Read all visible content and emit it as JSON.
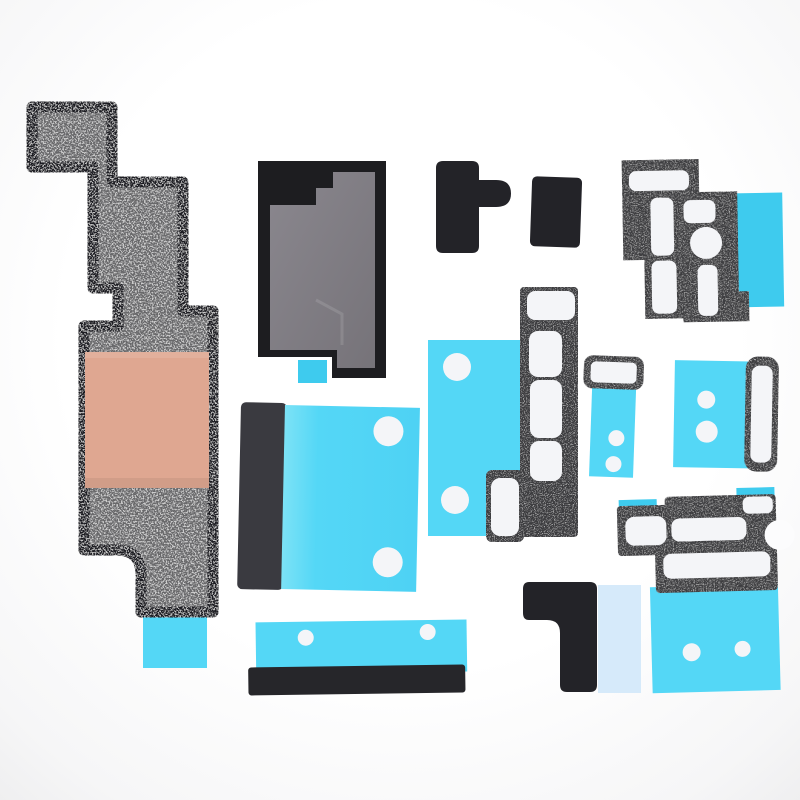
{
  "image": {
    "kind": "product-photo",
    "subject": "Set of phone internal adhesive insulator stickers and foam gaskets laid out on a white background",
    "piece_count": 12
  },
  "palette": {
    "background": "#fcfcfd",
    "outline": "#1d1d20",
    "graphite": "#67676b",
    "copper": "#dfa791",
    "cyan": "#54d7f6",
    "cyan_deep": "#3ecbee",
    "cyan_light": "#7ce2f6",
    "pale_blue": "#d6eafa",
    "charcoal": "#3d3d40",
    "black_part": "#232328",
    "gray_panel": "#7f7c83",
    "white_cutout": "#f4f5f8"
  },
  "parts": [
    {
      "id": "graphite-heatsink-pad",
      "label": "Graphite insulator pad with copper foil and liner tab",
      "fill": "graphite"
    },
    {
      "id": "shield-insulator-card",
      "label": "Board shield insulator card with liner tab",
      "fill": "gray_panel"
    },
    {
      "id": "connector-cover-tab",
      "label": "Small black cover with side tab",
      "fill": "black_part"
    },
    {
      "id": "connector-cover-small",
      "label": "Small black rectangular cover",
      "fill": "black_part"
    },
    {
      "id": "foam-gasket-upper-right",
      "label": "Foam gasket with adhesive cutouts on cyan liner",
      "fill": "charcoal"
    },
    {
      "id": "foam-gasket-mid",
      "label": "Vertical foam gasket strip on cyan liner sheet",
      "fill": "charcoal"
    },
    {
      "id": "adhesive-pad-left-center",
      "label": "Cyan adhesive pad with black edge bar",
      "fill": "cyan"
    },
    {
      "id": "gasket-with-tail",
      "label": "Small gasket lozenge with cyan tail",
      "fill": "charcoal"
    },
    {
      "id": "adhesive-pad-right",
      "label": "Cyan adhesive pad with vertical gasket lozenge",
      "fill": "cyan"
    },
    {
      "id": "foam-gasket-lower-right",
      "label": "Foam gasket bracket on cyan and pale-blue liners",
      "fill": "charcoal"
    },
    {
      "id": "bottom-adhesive-strip",
      "label": "Long cyan adhesive strip with black bar",
      "fill": "cyan"
    },
    {
      "id": "l-shaped-cover",
      "label": "Black L-shaped cover with pale-blue liner",
      "fill": "black_part"
    }
  ]
}
